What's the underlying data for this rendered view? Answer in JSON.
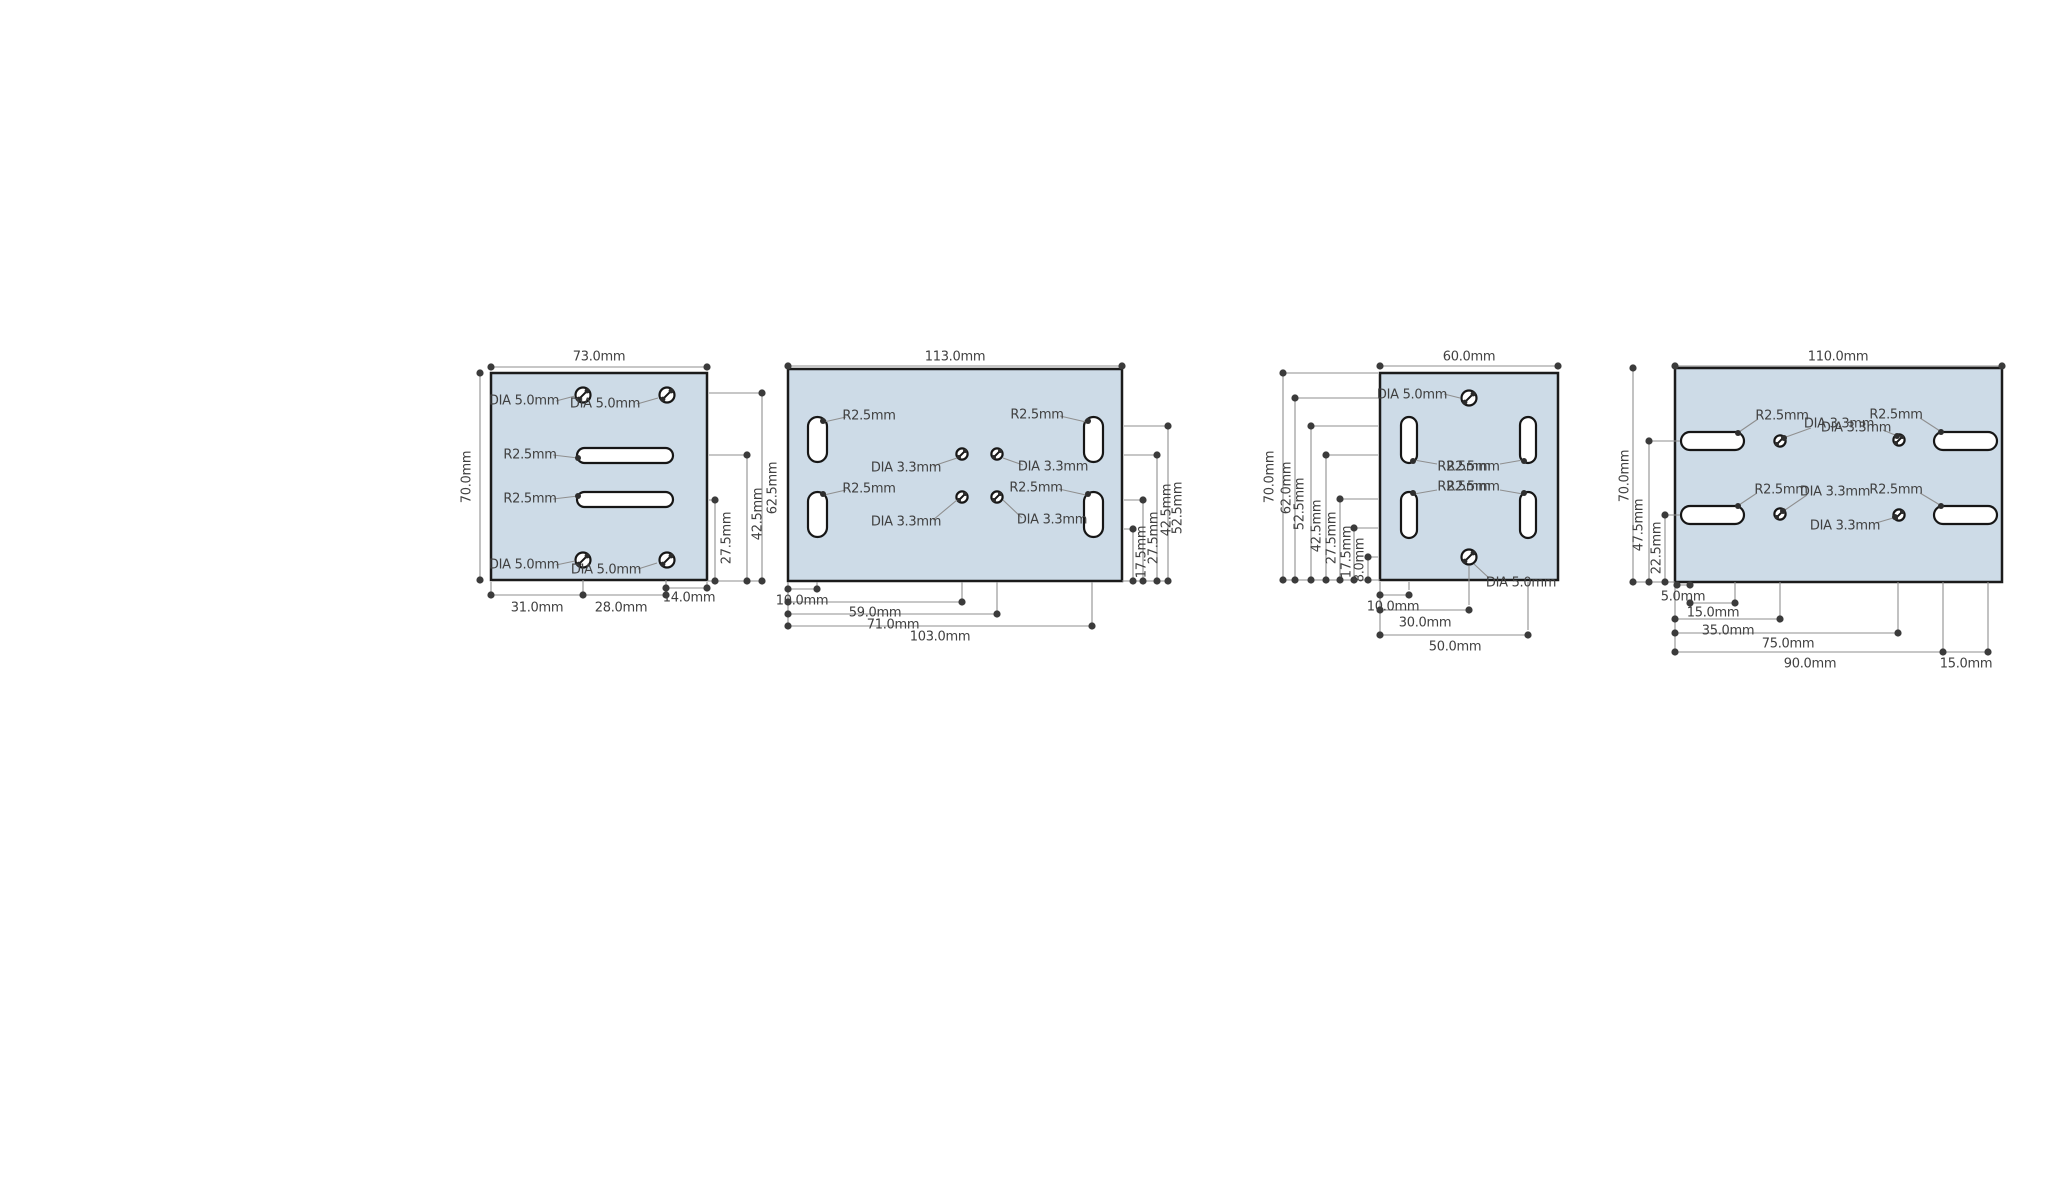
{
  "colors": {
    "plate_fill": "#cddbe7",
    "plate_stroke": "#1b1b1b",
    "dimension_line": "#8f8f8f",
    "dimension_dot": "#3b3b3b",
    "label_text": "#404040"
  },
  "drawings": [
    {
      "id": "plate-1",
      "width_dim": "73.0mm",
      "height_dim": "70.0mm",
      "right_dims": [
        "27.5mm",
        "42.5mm",
        "62.5mm"
      ],
      "bottom_dims": [
        "31.0mm",
        "28.0mm",
        "14.0mm"
      ],
      "hole_label": "DIA 5.0mm",
      "slot_label": "R2.5mm"
    },
    {
      "id": "plate-2",
      "width_dim": "113.0mm",
      "right_dims": [
        "17.5mm",
        "27.5mm",
        "42.5mm",
        "52.5mm"
      ],
      "bottom_dims": [
        "10.0mm",
        "59.0mm",
        "71.0mm",
        "103.0mm"
      ],
      "hole_label": "DIA 3.3mm",
      "slot_label": "R2.5mm"
    },
    {
      "id": "plate-3",
      "width_dim": "60.0mm",
      "left_dims": [
        "70.0mm",
        "62.0mm",
        "52.5mm",
        "42.5mm",
        "27.5mm",
        "17.5mm",
        "8.0mm"
      ],
      "bottom_dims": [
        "10.0mm",
        "30.0mm",
        "50.0mm"
      ],
      "hole_label": "DIA 5.0mm",
      "slot_label": "R2.5mm"
    },
    {
      "id": "plate-4",
      "width_dim": "110.0mm",
      "left_dims": [
        "70.0mm",
        "47.5mm",
        "22.5mm"
      ],
      "bottom_dims": [
        "5.0mm",
        "15.0mm",
        "35.0mm",
        "75.0mm",
        "90.0mm",
        "15.0mm"
      ],
      "hole_label": "DIA 3.3mm",
      "slot_label": "R2.5mm"
    }
  ]
}
